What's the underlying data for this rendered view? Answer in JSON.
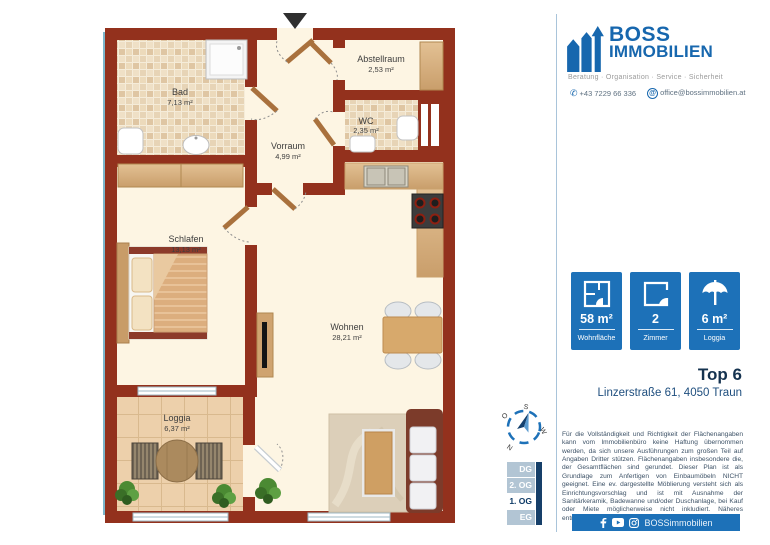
{
  "plan": {
    "rooms": {
      "bad": {
        "name": "Bad",
        "area": "7,13 m²"
      },
      "abstellraum": {
        "name": "Abstellraum",
        "area": "2,53 m²"
      },
      "wc": {
        "name": "WC",
        "area": "2,35 m²"
      },
      "vorraum": {
        "name": "Vorraum",
        "area": "4,99 m²"
      },
      "schlafen": {
        "name": "Schlafen",
        "area": "13,13 m²"
      },
      "wohnen": {
        "name": "Wohnen",
        "area": "28,21 m²"
      },
      "loggia": {
        "name": "Loggia",
        "area": "6,37 m²"
      }
    },
    "compass": {
      "north": "N",
      "south": "S",
      "east": "O",
      "west": "W"
    }
  },
  "sidebar": {
    "logo": {
      "name_line1": "BOSS",
      "name_line2": "IMMOBILIEN",
      "tagline": "Beratung · Organisation · Service · Sicherheit"
    },
    "contact": {
      "phone": "+43 7229 66 336",
      "email": "office@bossimmobilien.at"
    },
    "stats": [
      {
        "value": "58 m²",
        "label": "Wohnfläche"
      },
      {
        "value": "2",
        "label": "Zimmer"
      },
      {
        "value": "6 m²",
        "label": "Loggia"
      }
    ],
    "property": {
      "title": "Top 6",
      "address": "Linzerstraße 61, 4050 Traun"
    },
    "disclaimer": "Für die Vollständigkeit und Richtigkeit der Flächenangaben kann vom Immobilienbüro keine Haftung übernommen werden, da sich unsere Ausführungen zum großen Teil auf Angaben Dritter stützen. Flächenangaben insbesondere die, der Gesamtflächen sind gerundet. Dieser Plan ist als Grundlage zum Anfertigen von Einbaumöbeln NICHT geeignet. Eine ev. dargestellte Möblierung versteht sich als Einrichtungsvorschlag und ist mit Ausnahme der Sanitärkeramik, Badewanne und/oder Duschanlage, bei Kauf oder Miete möglicherweise nicht inkludiert. Näheres entnehmen Sie bitte aus dem Inserat.",
    "floors": {
      "items": [
        "DG",
        "2. OG",
        "1. OG",
        "EG"
      ],
      "active": "1. OG"
    },
    "footer": {
      "handle": "BOSSimmobilien"
    }
  },
  "colors": {
    "accent_blue": "#1d71b8",
    "logo_blue": "#1767ae",
    "wall_red": "#93311d",
    "navy": "#163f69",
    "floor_cream": "#fdf5e3"
  }
}
